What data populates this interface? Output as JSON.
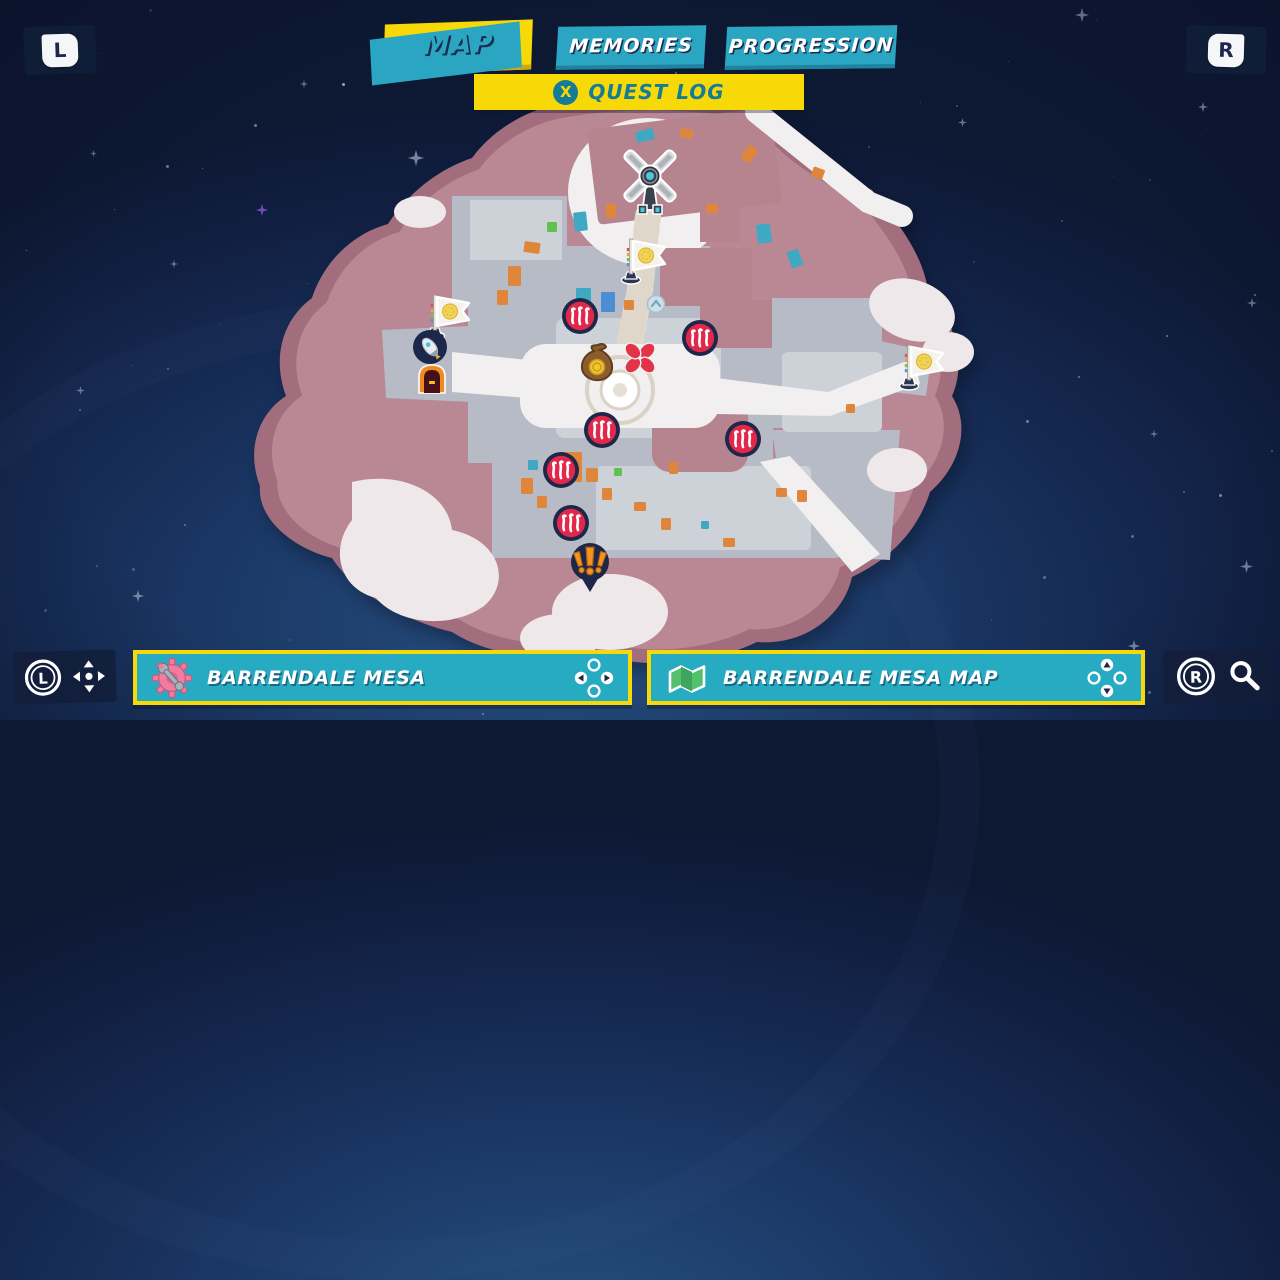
{
  "header": {
    "left_shoulder": "L",
    "right_shoulder": "R",
    "tabs": [
      {
        "label": "MAP",
        "active": true
      },
      {
        "label": "MEMORIES",
        "active": false
      },
      {
        "label": "PROGRESSION",
        "active": false
      }
    ],
    "quest_log": {
      "button": "X",
      "label": "QUEST LOG"
    }
  },
  "map": {
    "name": "Barrendale Mesa",
    "markers": [
      {
        "type": "windmill",
        "x": 650,
        "y": 187
      },
      {
        "type": "checkpoint-flag",
        "x": 644,
        "y": 262
      },
      {
        "type": "checkpoint-flag",
        "x": 448,
        "y": 318
      },
      {
        "type": "checkpoint-flag",
        "x": 922,
        "y": 368
      },
      {
        "type": "shop",
        "x": 430,
        "y": 349
      },
      {
        "type": "door",
        "x": 432,
        "y": 380
      },
      {
        "type": "lift",
        "x": 656,
        "y": 306
      },
      {
        "type": "battle",
        "x": 580,
        "y": 318
      },
      {
        "type": "battle",
        "x": 700,
        "y": 340
      },
      {
        "type": "battle",
        "x": 602,
        "y": 432
      },
      {
        "type": "battle",
        "x": 743,
        "y": 441
      },
      {
        "type": "battle",
        "x": 561,
        "y": 472
      },
      {
        "type": "battle",
        "x": 571,
        "y": 525
      },
      {
        "type": "coin-bag",
        "x": 597,
        "y": 366
      },
      {
        "type": "quest-target",
        "x": 640,
        "y": 360
      },
      {
        "type": "side-quest",
        "x": 590,
        "y": 570
      }
    ]
  },
  "footer": {
    "left_controls": {
      "button": "L",
      "action": "move"
    },
    "location": {
      "icon": "gear-wrench",
      "label": "BARRENDALE MESA"
    },
    "map_title": {
      "icon": "map",
      "label": "BARRENDALE MESA MAP"
    },
    "right_controls": {
      "button": "R",
      "action": "zoom"
    }
  },
  "colors": {
    "accent_yellow": "#F7D908",
    "accent_teal": "#26ABC2",
    "navy": "#1D2749",
    "battle_red": "#E1274A",
    "mesa_pink": "#B98794"
  }
}
